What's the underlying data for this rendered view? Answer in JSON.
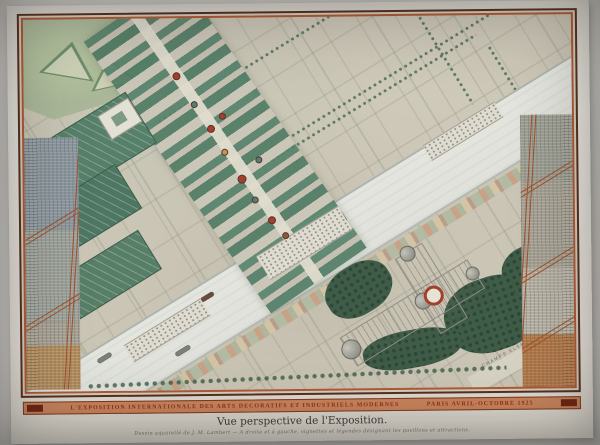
{
  "artwork": {
    "banner": {
      "title": "L'EXPOSITION INTERNATIONALE DES ARTS DECORATIFS ET INDUSTRIELS MODERNES",
      "dates": "PARIS AVRIL-OCTOBRE 1925"
    },
    "caption": {
      "title": "Vue perspective de l'Exposition.",
      "credit": "Dessin aquarellé de J. M. Lambert — A droite et à gauche, vignettes et légendes désignant les pavillons et attractions."
    },
    "map_labels": {
      "avenue_bottom_right": "CHAMPS ELYSEES"
    },
    "colors": {
      "frame_orange": "#b05a35",
      "frame_dark": "#53301f",
      "banner_background": "#c8845c",
      "banner_text": "#942f17",
      "river": "#e2e3dd",
      "park_green": "#aab899",
      "tree_dark_green": "#3e5c48",
      "pavilion_green": "#4e7a63",
      "accent_red": "#a53f2f",
      "paper": "#e8e5de",
      "map_base": "#cbc5b5"
    }
  }
}
